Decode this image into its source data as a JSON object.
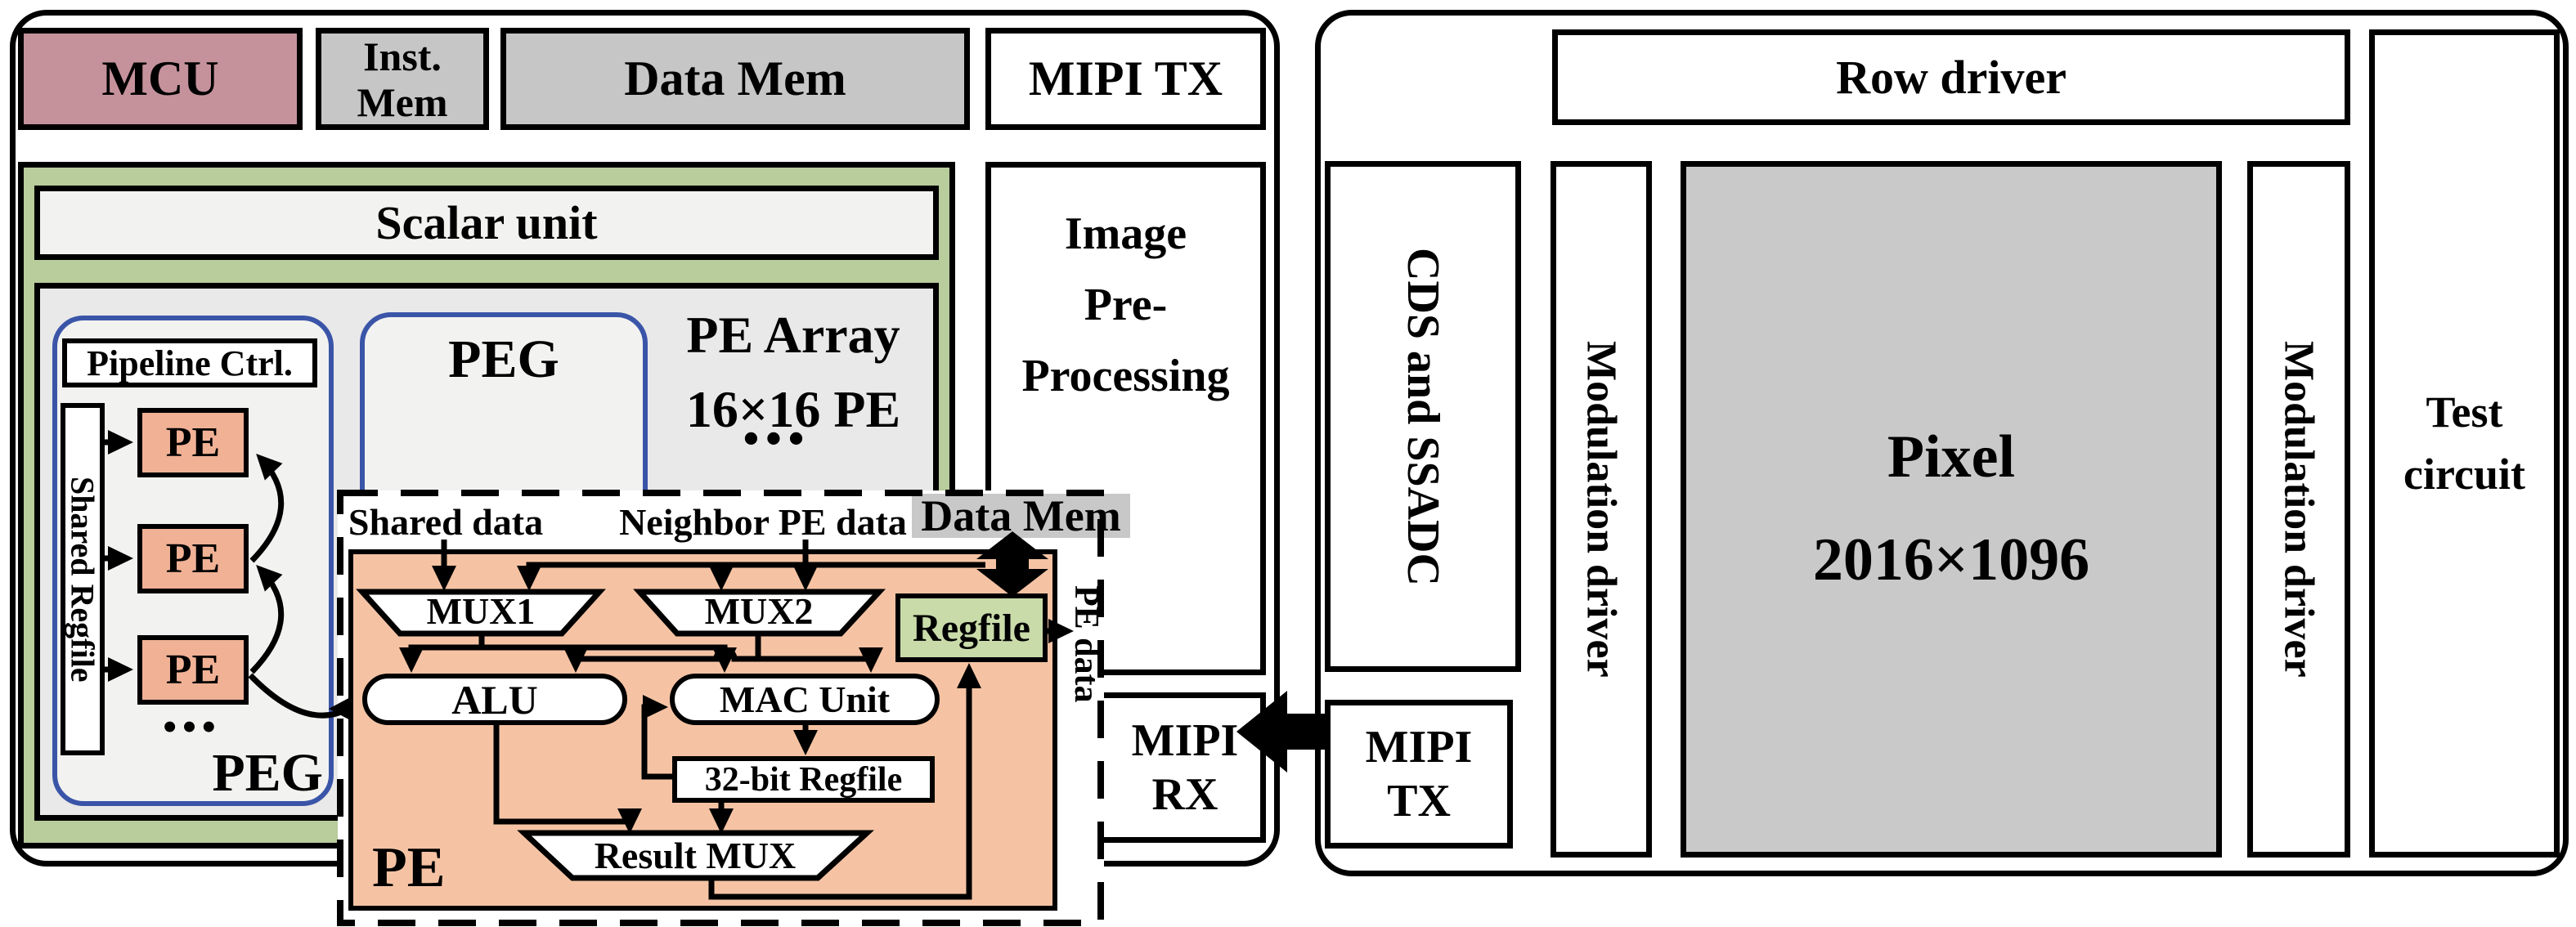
{
  "colors": {
    "mcu-pink": "#c5929c",
    "mem-gray": "#c6c6c6",
    "container-green": "#b8cc9c",
    "panel-white": "#f2f2f0",
    "array-gray": "#e9e9e9",
    "pe-orange": "#f0b195",
    "detail-orange": "#f5c3a4",
    "regfile-green": "#c9dba9",
    "blue-border": "#3a55a8",
    "pixel-gray": "#c9c9c9",
    "label-gray": "#c8c8c8"
  },
  "left_chip": {
    "mcu": "MCU",
    "inst_mem_l1": "Inst.",
    "inst_mem_l2": "Mem",
    "data_mem": "Data Mem",
    "mipi_tx": "MIPI TX",
    "scalar_unit": "Scalar unit",
    "pe_array_l1": "PE Array",
    "pe_array_l2": "16×16 PE",
    "ellipsis": "•••",
    "peg": "PEG",
    "pipeline_ctrl": "Pipeline Ctrl.",
    "shared_regfile": "Shared Regfile",
    "pe": "PE",
    "image_pre_l1": "Image",
    "image_pre_l2": "Pre-",
    "image_pre_l3": "Processing",
    "mipi_rx_l1": "MIPI",
    "mipi_rx_l2": "RX"
  },
  "pe_detail": {
    "shared_data": "Shared data",
    "neighbor_pe_data": "Neighbor PE data",
    "data_mem": "Data Mem",
    "mux1": "MUX1",
    "mux2": "MUX2",
    "regfile": "Regfile",
    "pe_data": "PE data",
    "alu": "ALU",
    "mac_unit": "MAC Unit",
    "regfile_32": "32-bit Regfile",
    "result_mux": "Result MUX",
    "pe": "PE"
  },
  "right_chip": {
    "row_driver": "Row driver",
    "cds_ssadc": "CDS and SSADC",
    "modulation_driver": "Modulation driver",
    "pixel_l1": "Pixel",
    "pixel_l2": "2016×1096",
    "mipi_tx_l1": "MIPI",
    "mipi_tx_l2": "TX",
    "test_circuit_l1": "Test",
    "test_circuit_l2": "circuit"
  }
}
